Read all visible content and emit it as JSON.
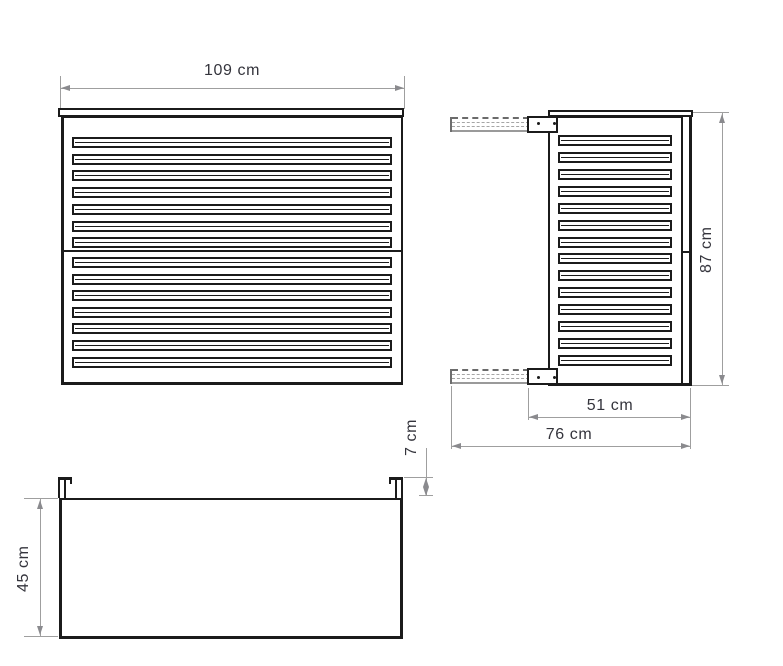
{
  "drawing_type": "technical-orthographic-views",
  "colors": {
    "outline": "#1b1b1b",
    "dimension_lines": "#9f9f9f",
    "dimension_text": "#34343c",
    "background": "#ffffff"
  },
  "views": {
    "front": {
      "description": "front view of louvered cover",
      "width_label": "109 cm",
      "slats_upper": 7,
      "slats_lower": 7
    },
    "side": {
      "description": "side view with wall-mount brackets",
      "height_label": "87 cm",
      "bracket_depth_label": "51 cm",
      "total_depth_label": "76 cm",
      "slats": 14
    },
    "plan": {
      "description": "top view of cover footprint",
      "depth_label": "45 cm",
      "bracket_lip_label": "7 cm"
    }
  }
}
